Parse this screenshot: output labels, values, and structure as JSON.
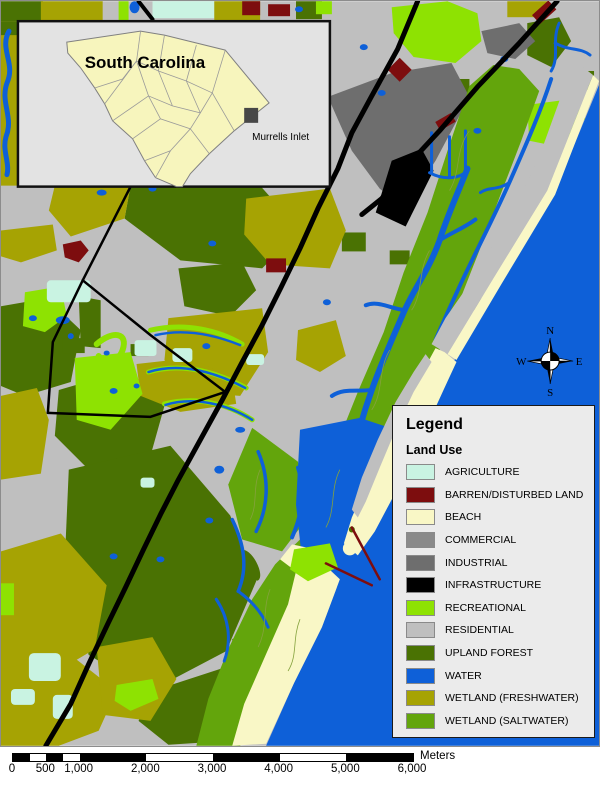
{
  "window": {
    "width": 600,
    "height": 785
  },
  "inset": {
    "title": "South Carolina",
    "marker_label": "Murrells Inlet"
  },
  "compass": {
    "north": "N",
    "east": "E",
    "south": "S",
    "west": "W"
  },
  "legend": {
    "title": "Legend",
    "subtitle": "Land Use",
    "items": [
      {
        "label": "AGRICULTURE",
        "color": "#c9f3e2"
      },
      {
        "label": "BARREN/DISTURBED LAND",
        "color": "#7d0d0e"
      },
      {
        "label": "BEACH",
        "color": "#f9f7c6"
      },
      {
        "label": "COMMERCIAL",
        "color": "#8a8a8a"
      },
      {
        "label": "INDUSTRIAL",
        "color": "#6e6e6e"
      },
      {
        "label": "INFRASTRUCTURE",
        "color": "#000000"
      },
      {
        "label": "RECREATIONAL",
        "color": "#8ee202"
      },
      {
        "label": "RESIDENTIAL",
        "color": "#bfbfbf"
      },
      {
        "label": "UPLAND FOREST",
        "color": "#4a7203"
      },
      {
        "label": "WATER",
        "color": "#0e60d8"
      },
      {
        "label": "WETLAND (FRESHWATER)",
        "color": "#a6a303"
      },
      {
        "label": "WETLAND (SALTWATER)",
        "color": "#63a50c"
      }
    ]
  },
  "scale_bar": {
    "tick_labels": [
      "0",
      "500",
      "1,000",
      "2,000",
      "3,000",
      "4,000",
      "5,000",
      "6,000"
    ],
    "tick_values_m": [
      0,
      500,
      1000,
      2000,
      3000,
      4000,
      5000,
      6000
    ],
    "segment_boundaries_m": [
      0,
      250,
      500,
      750,
      1000,
      2000,
      3000,
      4000,
      5000,
      6000
    ],
    "total_m": 6000,
    "unit_label": "Meters"
  },
  "palette": {
    "page_background": "#ffffff",
    "map_background": "#bfbfbf",
    "inset_background": "#e3e3e3",
    "state_fill": "#f7f5bd",
    "county_line": "#9a9a9a",
    "road": "#000000",
    "marsh_contour": "#85a23d",
    "jetty": "#7d0d0e",
    "frame": "#8c8c8c",
    "marker_fill": "#474747"
  }
}
